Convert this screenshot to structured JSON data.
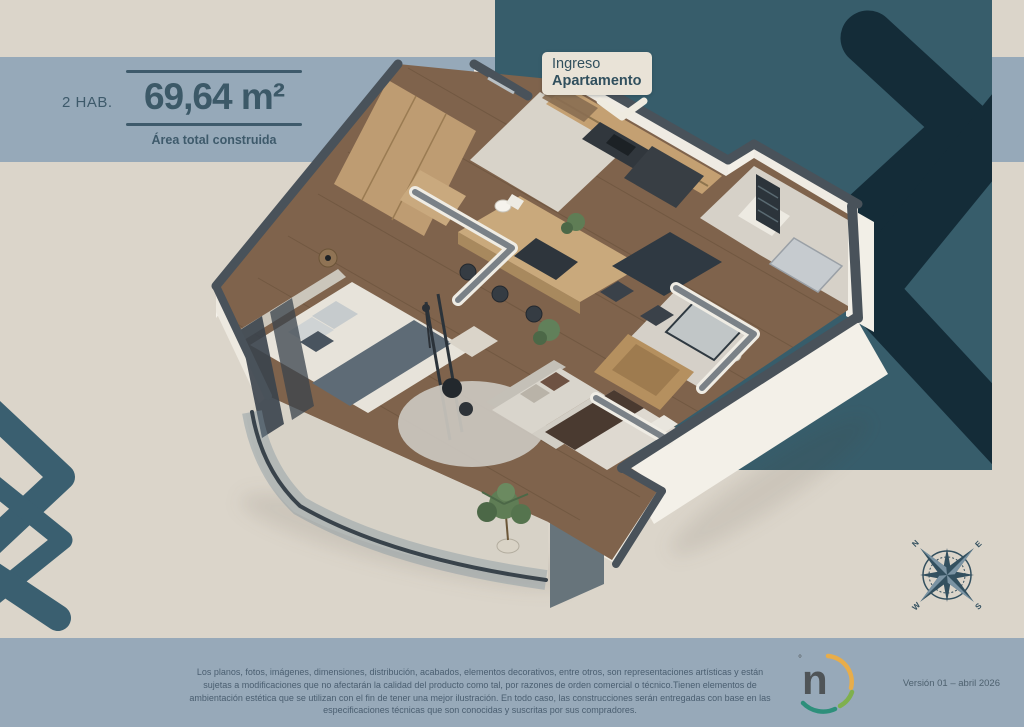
{
  "header": {
    "rooms_label": "2 HAB.",
    "area_value": "69,64 m²",
    "area_caption": "Área total construida"
  },
  "entrance_callout": {
    "line1": "Ingreso",
    "line2": "Apartamento"
  },
  "compass": {
    "north": "N",
    "east": "E",
    "south": "S",
    "west": "W"
  },
  "logo": {
    "letter": "n",
    "mark": "°"
  },
  "footer": {
    "disclaimer": "Los planos, fotos, imágenes, dimensiones, distribución, acabados, elementos decorativos, entre otros, son representaciones artísticas y están sujetas a modificaciones que no afectarán la calidad del producto como tal, por razones de orden comercial o técnico.Tienen elementos de ambientación estética que se utilizan con el fin de tener una mejor ilustración. En todo caso, las construcciones serán entregadas con base en las especificaciones técnicas que son conocidas y suscritas por sus compradores.",
    "version": "Versión 01 – abril 2026"
  },
  "colors": {
    "background_beige": "#DBD5CA",
    "panel_blue": "#96A9B9",
    "panel_teal": "#375D6B",
    "chevron_dark": "#142C38",
    "chevron_steel": "#3A5F70",
    "text_slate": "#3E5A6B",
    "wood_floor": "#7F634C",
    "logo_yellow": "#E8AD4A",
    "logo_green": "#7FB04E",
    "logo_teal": "#2E8F7B"
  }
}
